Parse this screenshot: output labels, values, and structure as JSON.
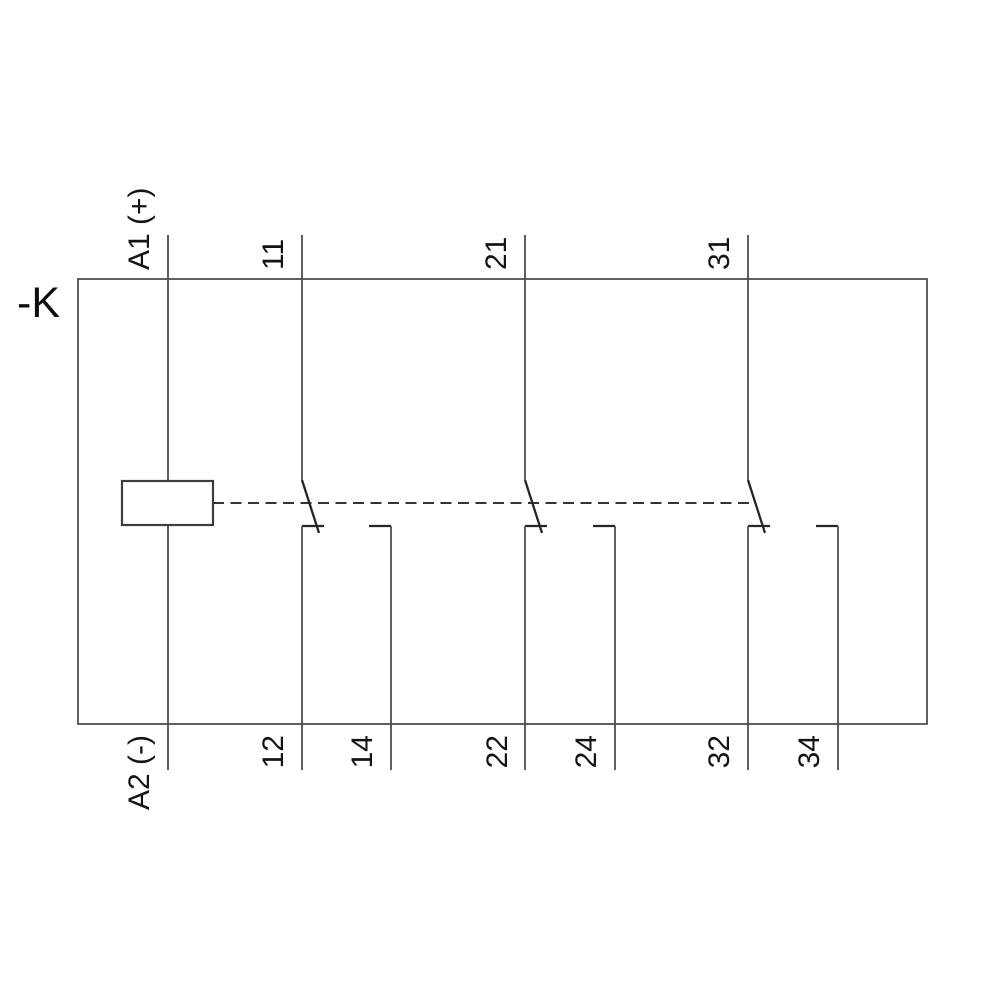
{
  "schematic": {
    "device_label": "-K",
    "coil": {
      "top_terminal": "A1 (+)",
      "bottom_terminal": "A2 (-)"
    },
    "contacts": [
      {
        "common": "11",
        "nc": "12",
        "no": "14"
      },
      {
        "common": "21",
        "nc": "22",
        "no": "24"
      },
      {
        "common": "31",
        "nc": "32",
        "no": "34"
      }
    ],
    "colors": {
      "line": "#4f4f4f",
      "symbol": "#262626",
      "text": "#141414",
      "background": "#ffffff"
    }
  }
}
